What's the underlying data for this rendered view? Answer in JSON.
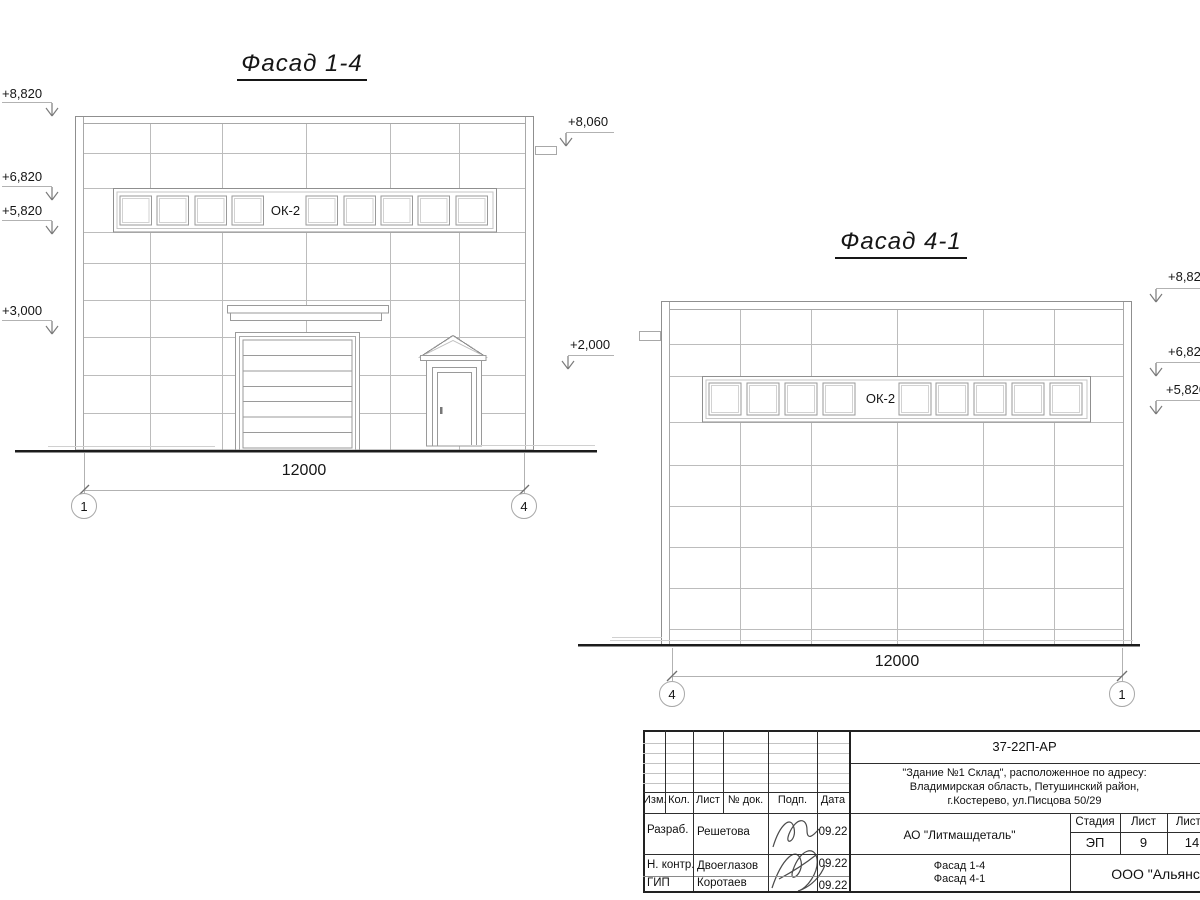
{
  "facade_left": {
    "title": "Фасад 1-4",
    "window_label": "ОК-2",
    "dimension": "12000",
    "axis_start": "1",
    "axis_end": "4",
    "elev_8820": "+8,820",
    "elev_6820": "+6,820",
    "elev_5820": "+5,820",
    "elev_3000": "+3,000",
    "elev_8060": "+8,060",
    "elev_2000": "+2,000"
  },
  "facade_right": {
    "title": "Фасад 4-1",
    "window_label": "ОК-2",
    "dimension": "12000",
    "axis_start": "4",
    "axis_end": "1",
    "elev_8820": "+8,820",
    "elev_6820": "+6,820",
    "elev_5820": "+5,820"
  },
  "title_block": {
    "doc_number": "37-22П-АР",
    "address_line1": "\"Здание №1 Склад\", расположенное по адресу:",
    "address_line2": "Владимирская область, Петушинский район,",
    "address_line3": "г.Костерево, ул.Писцова 50/29",
    "col_izm": "Изм.",
    "col_kol": "Кол.",
    "col_list": "Лист",
    "col_doc": "№ док.",
    "col_podp": "Подп.",
    "col_data": "Дата",
    "row1_role": "Разраб.",
    "row1_name": "Решетова",
    "row1_date": "09.22",
    "row2_role": "Н. контр.",
    "row2_name": "Двоеглазов",
    "row2_date": "09.22",
    "row3_role": "ГИП",
    "row3_name": "Коротаев",
    "row3_date": "09.22",
    "company": "АО \"Литмашдеталь\"",
    "stage_label": "Стадия",
    "sheet_label": "Лист",
    "sheets_label": "Листов",
    "stage_value": "ЭП",
    "sheet_value": "9",
    "sheets_value": "14",
    "drawing_title_line1": "Фасад 1-4",
    "drawing_title_line2": "Фасад 4-1",
    "organization": "ООО \"Альянс\""
  }
}
